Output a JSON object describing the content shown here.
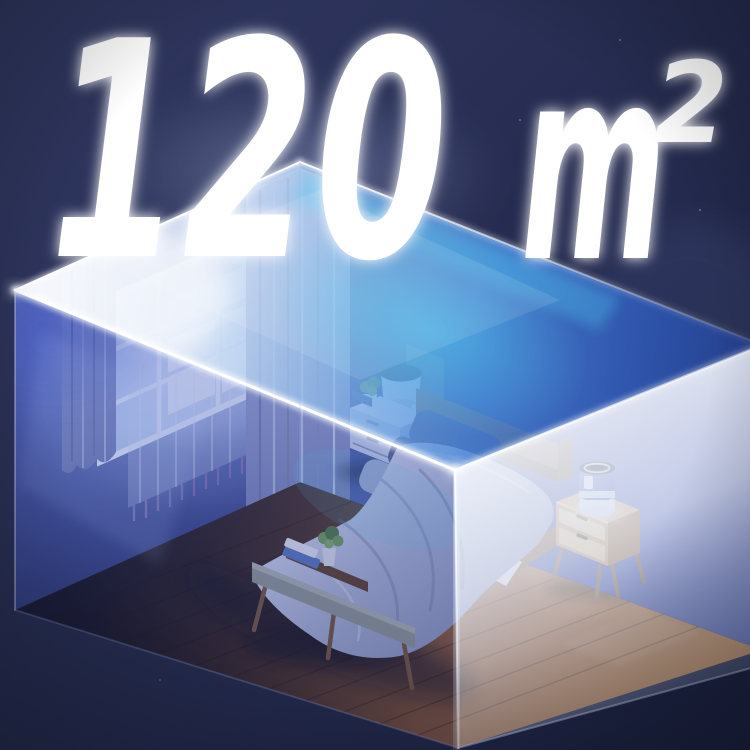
{
  "headline": {
    "value": "120",
    "unit": "m²",
    "unit_base": "m",
    "unit_exponent": "2"
  },
  "scene": {
    "description": "Isometric night-time bedroom enclosed in a glowing translucent glass box — bed with lavender duvet, curtained window, bench with plant and books, and a small blue air purifier glowing warmly on a wooden bedside table.",
    "label": "coverage-area-illustration"
  },
  "colors": {
    "background_navy": "#262c50",
    "glass_blue": "#4054ba",
    "glow_cyan": "#4fd2f4",
    "glass_white": "#e6e9f4",
    "wall_blue": "#46549e",
    "floor_wood": "#7c4e2c",
    "warm_glow": "#f2a85c",
    "purifier_blue": "#5671c4",
    "curtain_lavender": "#9aa3cc",
    "text_white": "#ffffff"
  }
}
